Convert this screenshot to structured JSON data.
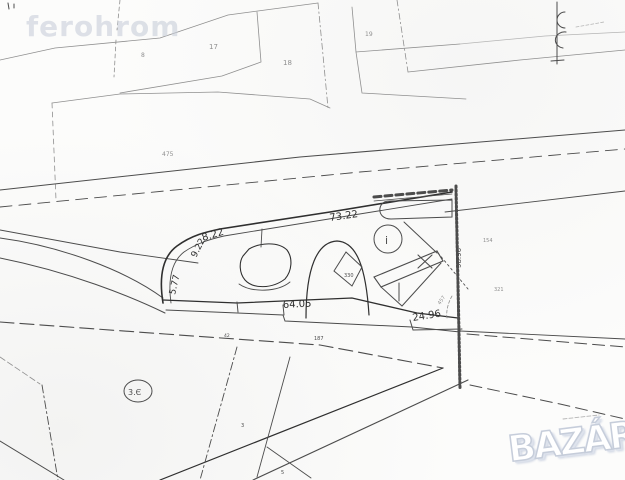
{
  "watermark": {
    "text": "ferohrom"
  },
  "logo": {
    "text": "BAZÁR"
  },
  "map": {
    "background": "#fcfcfb",
    "ink": {
      "bold": "#2f2f2f",
      "med": "#4c4c4c",
      "light": "#8f8f8f",
      "faint": "#b5b5b5"
    },
    "labels": [
      {
        "name": "parcel-number",
        "text": "8",
        "x": 141,
        "y": 57,
        "size": 6,
        "color": "light"
      },
      {
        "name": "parcel-number",
        "text": "17",
        "x": 209,
        "y": 49,
        "size": 7,
        "color": "light"
      },
      {
        "name": "parcel-number",
        "text": "18",
        "x": 283,
        "y": 65,
        "size": 7,
        "color": "light"
      },
      {
        "name": "parcel-number",
        "text": "19",
        "x": 365,
        "y": 36,
        "size": 6,
        "color": "light"
      },
      {
        "name": "parcel-number",
        "text": "475",
        "x": 162,
        "y": 156,
        "size": 6,
        "color": "light"
      },
      {
        "name": "dimension",
        "text": "73.22",
        "x": 330,
        "y": 221,
        "size": 10,
        "rot": -8,
        "color": "bold"
      },
      {
        "name": "dimension",
        "text": "8.22",
        "x": 203,
        "y": 241,
        "size": 10,
        "rot": -17,
        "color": "bold"
      },
      {
        "name": "dimension",
        "text": "9.22",
        "x": 196,
        "y": 258,
        "size": 9,
        "rot": -63,
        "color": "bold"
      },
      {
        "name": "dimension",
        "text": "5.77",
        "x": 175,
        "y": 295,
        "size": 9,
        "rot": -77,
        "color": "bold"
      },
      {
        "name": "dimension",
        "text": "64.05",
        "x": 283,
        "y": 308,
        "size": 10,
        "rot": -3,
        "color": "bold"
      },
      {
        "name": "dimension",
        "text": "24.96",
        "x": 413,
        "y": 321,
        "size": 10,
        "rot": -9,
        "color": "bold"
      },
      {
        "name": "dimension",
        "text": "98.96",
        "x": 461,
        "y": 268,
        "size": 7,
        "rot": -90,
        "color": "med"
      },
      {
        "name": "parcel-number",
        "text": "154",
        "x": 483,
        "y": 242,
        "size": 5,
        "color": "light"
      },
      {
        "name": "parcel-number",
        "text": "321",
        "x": 494,
        "y": 291,
        "size": 5,
        "color": "light"
      },
      {
        "name": "building-number",
        "text": "330",
        "x": 344,
        "y": 277,
        "size": 5,
        "color": "med"
      },
      {
        "name": "road-number",
        "text": "187",
        "x": 314,
        "y": 340,
        "size": 5,
        "color": "med"
      },
      {
        "name": "road-number",
        "text": "42",
        "x": 224,
        "y": 337,
        "size": 4.5,
        "color": "med"
      },
      {
        "name": "parcel-number",
        "text": "3",
        "x": 241,
        "y": 427,
        "size": 5,
        "color": "med"
      },
      {
        "name": "parcel-number",
        "text": "5",
        "x": 281,
        "y": 474,
        "size": 5,
        "color": "med"
      },
      {
        "name": "info-symbol",
        "text": "i",
        "x": 385,
        "y": 244,
        "size": 11,
        "color": "med"
      },
      {
        "name": "circled-number",
        "text": "3.Є",
        "x": 128,
        "y": 395,
        "size": 8,
        "color": "med"
      },
      {
        "name": "handwritten-note",
        "text": "457",
        "x": 440,
        "y": 305,
        "size": 5,
        "rot": -55,
        "color": "light"
      }
    ],
    "paths": [
      {
        "name": "top-parcel-boundary",
        "d": "M0,60 L55,48 L160,38 L228,15 L318,3",
        "color": "light",
        "width": 0.8
      },
      {
        "name": "top-parcel-divider",
        "d": "M318,3 L323,55 L328,108",
        "color": "light",
        "width": 0.8,
        "dash": "6,3,1.5,3"
      },
      {
        "name": "top-parcel-divider",
        "d": "M257,12 L261,62 L222,76 L120,93",
        "color": "light",
        "width": 0.8
      },
      {
        "name": "top-parcel-boundary",
        "d": "M52,103 L120,94 L218,92 L310,99 L330,108",
        "color": "light",
        "width": 0.8
      },
      {
        "name": "top-parcel-divider",
        "d": "M52,103 L56,200",
        "color": "light",
        "width": 0.8,
        "dash": "5,4"
      },
      {
        "name": "top-parcel-boundary",
        "d": "M352,7 L356,52 L460,44",
        "color": "light",
        "width": 0.8
      },
      {
        "name": "top-parcel-boundary",
        "d": "M356,52 L362,93 L466,99",
        "color": "light",
        "width": 0.8
      },
      {
        "name": "top-parcel-divider",
        "d": "M397,0 L408,72",
        "color": "light",
        "width": 0.8,
        "dash": "6,3,1.5,3"
      },
      {
        "name": "top-parcel-boundary",
        "d": "M408,72 L520,60 L625,50",
        "color": "light",
        "width": 0.8
      },
      {
        "name": "top-parcel-boundary",
        "d": "M460,44 L545,36 L625,32",
        "color": "faint",
        "width": 0.8
      },
      {
        "name": "top-parcel-divider",
        "d": "M120,0 L117,30",
        "color": "light",
        "width": 0.8,
        "dash": "4,3"
      },
      {
        "name": "top-parcel-divider",
        "d": "M116,40 L114,77",
        "color": "light",
        "width": 0.8,
        "dash": "4,3"
      },
      {
        "name": "scan-speck",
        "d": "M8,3 L9,9 M14,4 L14,8",
        "color": "med",
        "width": 1
      },
      {
        "name": "utility-pole-symbol",
        "d": "M557,2 L557,64",
        "color": "med",
        "width": 1
      },
      {
        "name": "utility-pole-symbol",
        "d": "M565,12 A8,8 0 1 0 565,28 M566,32 A9,8 0 1 0 563,48",
        "color": "med",
        "width": 1
      },
      {
        "name": "utility-pole-symbol",
        "d": "M551,61 L564,60",
        "color": "med",
        "width": 1
      },
      {
        "name": "scan-scribble",
        "d": "M576,27 L604,22",
        "color": "faint",
        "width": 0.8,
        "dash": "3,2"
      },
      {
        "name": "scan-scribble",
        "d": "M563,419 L599,415",
        "color": "faint",
        "width": 0.9,
        "dash": "4,2"
      },
      {
        "name": "road-edge",
        "d": "M0,190 L300,157 L625,130",
        "color": "med",
        "width": 1
      },
      {
        "name": "road-centerline",
        "d": "M0,207 L360,172 L625,149",
        "color": "med",
        "width": 0.9,
        "dash": "12,7"
      },
      {
        "name": "road-edge",
        "d": "M0,230 L120,252 L198,263",
        "color": "med",
        "width": 0.9
      },
      {
        "name": "road-edge",
        "d": "M0,238 C60,246 125,270 163,298",
        "color": "med",
        "width": 1
      },
      {
        "name": "road-edge",
        "d": "M0,258 C70,272 130,296 165,313",
        "color": "med",
        "width": 1
      },
      {
        "name": "plot-boundary-outer",
        "d": "M163,303 C159,278 162,257 177,246 C192,235 206,232 220,229 L330,212 L452,192",
        "color": "bold",
        "width": 1.6
      },
      {
        "name": "plot-boundary-inner",
        "d": "M171,303 C168,281 171,262 184,252 C197,243 211,239 224,236 L452,199",
        "color": "med",
        "width": 0.9
      },
      {
        "name": "plot-boundary-bottom",
        "d": "M163,300 L237,303 L352,298 L417,313 L458,318",
        "color": "bold",
        "width": 1.3
      },
      {
        "name": "plot-boundary-bottom",
        "d": "M166,310 L283,315 L285,321 L412,327 L460,332",
        "color": "med",
        "width": 1
      },
      {
        "name": "dimension-tick",
        "d": "M237,302 L238,312",
        "color": "med",
        "width": 1
      },
      {
        "name": "dimension-tick",
        "d": "M283,305 L284,315",
        "color": "med",
        "width": 1
      },
      {
        "name": "dimension-bracket",
        "d": "M410,320 L413,330 L462,329",
        "color": "med",
        "width": 1
      },
      {
        "name": "hatched-boundary",
        "d": "M456,186 L459,332 L460,388",
        "color": "med",
        "width": 3,
        "dash": "1.5,2.5"
      },
      {
        "name": "hatched-boundary",
        "d": "M455,186 L458,332 L459,388",
        "color": "med",
        "width": 0.8
      },
      {
        "name": "ticked-boundary",
        "d": "M374,197 L452,190",
        "color": "med",
        "width": 3,
        "dash": "7,4"
      },
      {
        "name": "ticked-boundary",
        "d": "M374,201 L452,194",
        "color": "med",
        "width": 0.8
      },
      {
        "name": "building-outline",
        "d": "M390,201 L452,200 L452,217 L391,219 C383,219 379,214 380,208 C381,203 385,201 390,201 Z",
        "color": "med",
        "width": 1
      },
      {
        "name": "leader-line",
        "d": "M404,222 L437,253",
        "color": "med",
        "width": 1
      },
      {
        "name": "parcel-boundary-right",
        "d": "M445,212 L625,191",
        "color": "med",
        "width": 0.9
      },
      {
        "name": "parcel-boundary-right",
        "d": "M460,331 L625,339",
        "color": "med",
        "width": 0.9
      },
      {
        "name": "pond-outline",
        "d": "M249,249 C259,243 278,241 287,250 C293,258 292,271 285,279 C272,289 253,289 245,280 C239,273 239,262 243,256 Z",
        "color": "bold",
        "width": 1.1
      },
      {
        "name": "pond-outline",
        "d": "M239,284 C252,293 278,292 290,282",
        "color": "med",
        "width": 0.9
      },
      {
        "name": "connector-line",
        "d": "M262,229 L261,247",
        "color": "med",
        "width": 0.9
      },
      {
        "name": "arch-outline",
        "d": "M306,318 C306,268 317,242 337,241 C357,242 366,268 369,315",
        "color": "bold",
        "width": 1.2
      },
      {
        "name": "building-outline",
        "d": "M346,252 L362,267 L352,286 L334,271 Z",
        "color": "med",
        "width": 1
      },
      {
        "name": "structure-outline",
        "d": "M374,277 L437,251 L443,261 L381,287 Z",
        "color": "med",
        "width": 1.1
      },
      {
        "name": "structure-outline",
        "d": "M381,287 L402,306 L441,263",
        "color": "med",
        "width": 1
      },
      {
        "name": "structure-outline",
        "d": "M399,283 L399,301",
        "color": "med",
        "width": 1
      },
      {
        "name": "x-mark",
        "d": "M418,255 L432,268 M432,255 L418,268",
        "color": "med",
        "width": 1.1
      },
      {
        "name": "boundary-dashdot",
        "d": "M438,253 L468,289",
        "color": "med",
        "width": 0.9,
        "dash": "2,3"
      },
      {
        "name": "boundary-dashed",
        "d": "M452,296 C448,303 446,311 447,318",
        "color": "light",
        "width": 0.8,
        "dash": "3,2"
      },
      {
        "name": "road-dashed",
        "d": "M0,322 L165,334 L320,345 L443,368",
        "color": "med",
        "width": 1.1,
        "dash": "14,6"
      },
      {
        "name": "road-dashed",
        "d": "M467,334 L625,347",
        "color": "med",
        "width": 1,
        "dash": "12,6"
      },
      {
        "name": "road-dashed",
        "d": "M470,385 L560,404 L625,419",
        "color": "med",
        "width": 1,
        "dash": "12,6"
      },
      {
        "name": "road-edge",
        "d": "M443,368 L160,480",
        "color": "bold",
        "width": 1.2
      },
      {
        "name": "road-edge",
        "d": "M468,380 L253,480",
        "color": "med",
        "width": 1.1
      },
      {
        "name": "boundary-dashdot",
        "d": "M237,347 L200,480",
        "color": "med",
        "width": 0.9,
        "dash": "8,3,2,3"
      },
      {
        "name": "parcel-boundary",
        "d": "M290,357 L257,477",
        "color": "med",
        "width": 0.9
      },
      {
        "name": "parcel-boundary",
        "d": "M267,447 L311,478",
        "color": "med",
        "width": 0.9
      },
      {
        "name": "boundary-dashdot",
        "d": "M42,385 L58,480",
        "color": "med",
        "width": 0.9,
        "dash": "8,3,2,3"
      },
      {
        "name": "road-edge",
        "d": "M0,441 L64,480",
        "color": "med",
        "width": 1
      },
      {
        "name": "boundary-dashed",
        "d": "M0,357 L40,384",
        "color": "light",
        "width": 0.8,
        "dash": "6,3"
      },
      {
        "name": "circled-number-ellipse",
        "d": "M124,391 a14,11 0 1 0 28,0 a14,11 0 1 0 -28,0",
        "color": "med",
        "width": 1
      },
      {
        "name": "info-circle",
        "d": "M374,239 a14,14 0 1 0 28,0 a14,14 0 1 0 -28,0",
        "color": "med",
        "width": 1
      }
    ]
  }
}
